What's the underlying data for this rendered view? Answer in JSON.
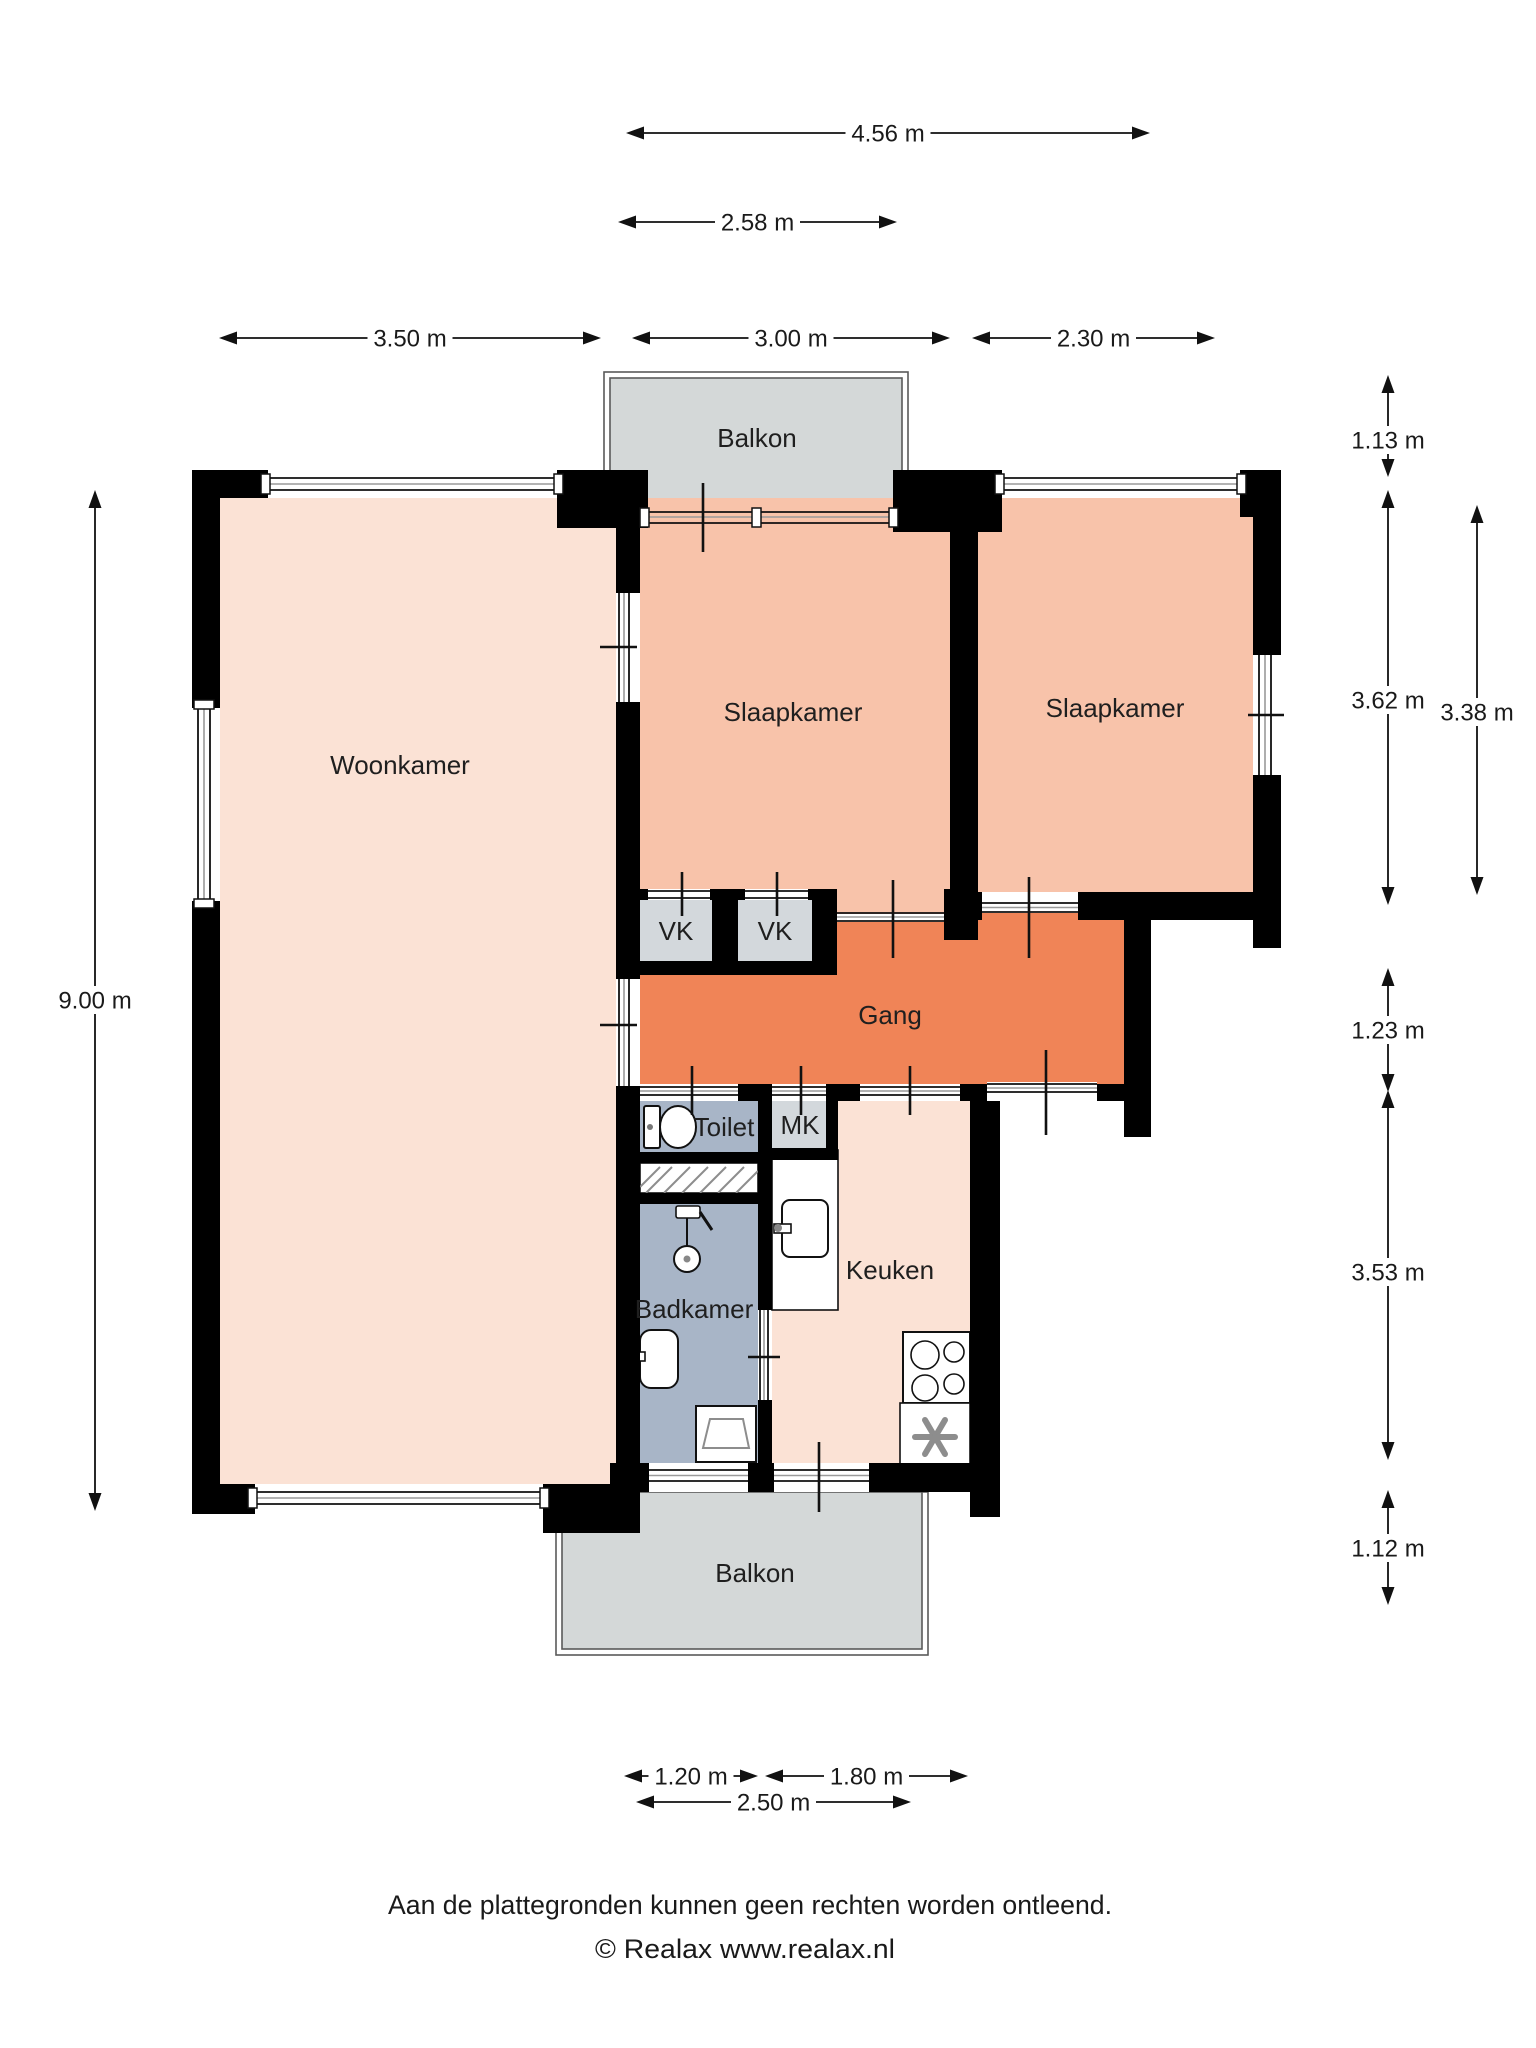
{
  "plan_title": "Apartment floor plan",
  "colors": {
    "living": "#fbe2d5",
    "bedroom": "#f8c3aa",
    "hall": "#f08457",
    "wet": "#a8b5c7",
    "closet": "#d3d8dc",
    "balcony": "#d4d8d8",
    "wall": "#000000",
    "background": "#ffffff",
    "text": "#1f1f1f"
  },
  "rooms": [
    {
      "id": "balkon-top",
      "label": "Balkon",
      "cx": 757,
      "cy": 447
    },
    {
      "id": "woonkamer",
      "label": "Woonkamer",
      "cx": 400,
      "cy": 774
    },
    {
      "id": "slaapkamer-1",
      "label": "Slaapkamer",
      "cx": 793,
      "cy": 721
    },
    {
      "id": "slaapkamer-2",
      "label": "Slaapkamer",
      "cx": 1115,
      "cy": 717
    },
    {
      "id": "gang",
      "label": "Gang",
      "cx": 890,
      "cy": 1024
    },
    {
      "id": "vk-1",
      "label": "VK",
      "cx": 676,
      "cy": 940
    },
    {
      "id": "vk-2",
      "label": "VK",
      "cx": 775,
      "cy": 940
    },
    {
      "id": "toilet",
      "label": "Toilet",
      "cx": 724,
      "cy": 1136
    },
    {
      "id": "mk",
      "label": "MK",
      "cx": 800,
      "cy": 1134
    },
    {
      "id": "badkamer",
      "label": "Badkamer",
      "cx": 694,
      "cy": 1318
    },
    {
      "id": "keuken",
      "label": "Keuken",
      "cx": 890,
      "cy": 1279
    },
    {
      "id": "balkon-bottom",
      "label": "Balkon",
      "cx": 755,
      "cy": 1582
    }
  ],
  "dimensions": {
    "horizontal": [
      {
        "id": "dim-4-56",
        "label": "4.56 m",
        "x1": 626,
        "x2": 1150,
        "y": 133
      },
      {
        "id": "dim-2-58",
        "label": "2.58 m",
        "x1": 618,
        "x2": 897,
        "y": 222
      },
      {
        "id": "dim-3-50",
        "label": "3.50 m",
        "x1": 219,
        "x2": 601,
        "y": 338
      },
      {
        "id": "dim-3-00",
        "label": "3.00 m",
        "x1": 632,
        "x2": 950,
        "y": 338
      },
      {
        "id": "dim-2-30",
        "label": "2.30 m",
        "x1": 972,
        "x2": 1215,
        "y": 338
      },
      {
        "id": "dim-1-20",
        "label": "1.20 m",
        "x1": 624,
        "x2": 758,
        "y": 1776
      },
      {
        "id": "dim-1-80",
        "label": "1.80 m",
        "x1": 765,
        "x2": 968,
        "y": 1776
      },
      {
        "id": "dim-2-50",
        "label": "2.50 m",
        "x1": 636,
        "x2": 911,
        "y": 1802
      }
    ],
    "vertical": [
      {
        "id": "dim-9-00",
        "label": "9.00 m",
        "x": 95,
        "y1": 490,
        "y2": 1511,
        "ty": 1000
      },
      {
        "id": "dim-1-13",
        "label": "1.13 m",
        "x": 1388,
        "y1": 375,
        "y2": 477,
        "ty": 440
      },
      {
        "id": "dim-3-62",
        "label": "3.62 m",
        "x": 1388,
        "y1": 490,
        "y2": 905,
        "ty": 700
      },
      {
        "id": "dim-3-38",
        "label": "3.38 m",
        "x": 1477,
        "y1": 505,
        "y2": 895,
        "ty": 712
      },
      {
        "id": "dim-1-23",
        "label": "1.23 m",
        "x": 1388,
        "y1": 968,
        "y2": 1092,
        "ty": 1030
      },
      {
        "id": "dim-3-53",
        "label": "3.53 m",
        "x": 1388,
        "y1": 1090,
        "y2": 1460,
        "ty": 1272
      },
      {
        "id": "dim-1-12",
        "label": "1.12 m",
        "x": 1388,
        "y1": 1490,
        "y2": 1605,
        "ty": 1548
      }
    ]
  },
  "footer": {
    "line1": "Aan de plattegronden kunnen geen rechten worden ontleend.",
    "line2": "© Realax www.realax.nl"
  }
}
